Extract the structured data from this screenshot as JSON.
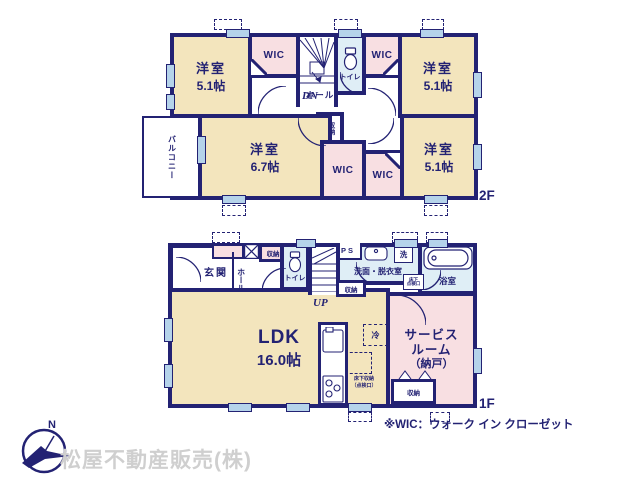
{
  "colors": {
    "wall": "#232273",
    "room_cream": "#f3e5bd",
    "room_pink": "#f8dfe2",
    "room_blue": "#dfeef6",
    "window_blue": "#b5d3ea",
    "company_gray": "#cfcfcf"
  },
  "floor2": {
    "floor_label": "2F",
    "bedroom_tl": {
      "name": "洋室",
      "size": "5.1帖"
    },
    "bedroom_tr": {
      "name": "洋室",
      "size": "5.1帖"
    },
    "bedroom_bl": {
      "name": "洋室",
      "size": "6.7帖"
    },
    "bedroom_br": {
      "name": "洋室",
      "size": "5.1帖"
    },
    "wic_tl": "WIC",
    "wic_tr": "WIC",
    "wic_bottom_center": "WIC",
    "wic_bottom_right": "WIC",
    "toilet": "トイレ",
    "hall": "ホール",
    "closet": "収納",
    "balcony": "バルコニー",
    "stairs": "DN"
  },
  "floor1": {
    "floor_label": "1F",
    "entrance": "玄関",
    "hall": "ホール",
    "hall_closet": "収納",
    "toilet": "トイレ",
    "stairs": "UP",
    "stairs_closet": "収納",
    "pipe_space": "PS",
    "washroom": "洗面・脱衣室",
    "laundry": "洗",
    "underfloor_hatch_line1": "床下",
    "underfloor_hatch_line2": "点検口",
    "bathroom": "浴室",
    "ldk": {
      "name": "LDK",
      "size": "16.0帖"
    },
    "refrigerator": "冷",
    "floor_storage_line1": "床下収納",
    "floor_storage_line2": "（点検口）",
    "service_room_line1": "サービス",
    "service_room_line2": "ルーム",
    "service_room_line3": "（納戸）",
    "service_closet": "収納"
  },
  "footer": {
    "compass_north": "N",
    "company": "松屋不動産販売(株)",
    "wic_note": "※WIC：ウォーク イン クローゼット"
  }
}
